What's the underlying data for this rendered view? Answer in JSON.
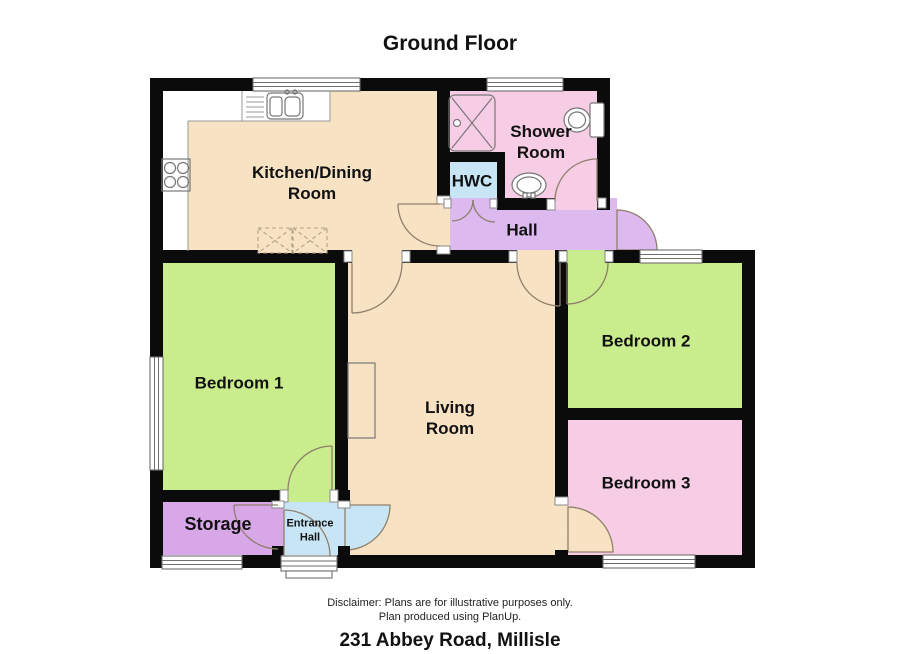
{
  "title": "Ground Floor",
  "rooms": {
    "kitchen": {
      "label": "Kitchen/Dining\nRoom"
    },
    "shower": {
      "label": "Shower\nRoom"
    },
    "hwc": {
      "label": "HWC"
    },
    "hall": {
      "label": "Hall"
    },
    "bedroom1": {
      "label": "Bedroom 1"
    },
    "bedroom2": {
      "label": "Bedroom 2"
    },
    "bedroom3": {
      "label": "Bedroom 3"
    },
    "living": {
      "label": "Living\nRoom"
    },
    "storage": {
      "label": "Storage"
    },
    "entrance_hall": {
      "label": "Entrance\nHall"
    }
  },
  "footer": {
    "disclaimer_line1": "Disclaimer: Plans are for illustrative purposes only.",
    "disclaimer_line2": "Plan produced using PlanUp.",
    "address": "231 Abbey Road, Millisle"
  },
  "colors": {
    "floor-cream": "#F7E3C4",
    "room-green": "#C9EC8C",
    "room-pink": "#F7CCE5",
    "hall-lavender": "#DCBAF0",
    "storage-plum": "#D8A7E8",
    "room-blue": "#C8E5F6",
    "wall-black": "#0B0B0B",
    "arc-stroke": "#8F7F6B",
    "dashed-stroke": "#B3A284"
  }
}
